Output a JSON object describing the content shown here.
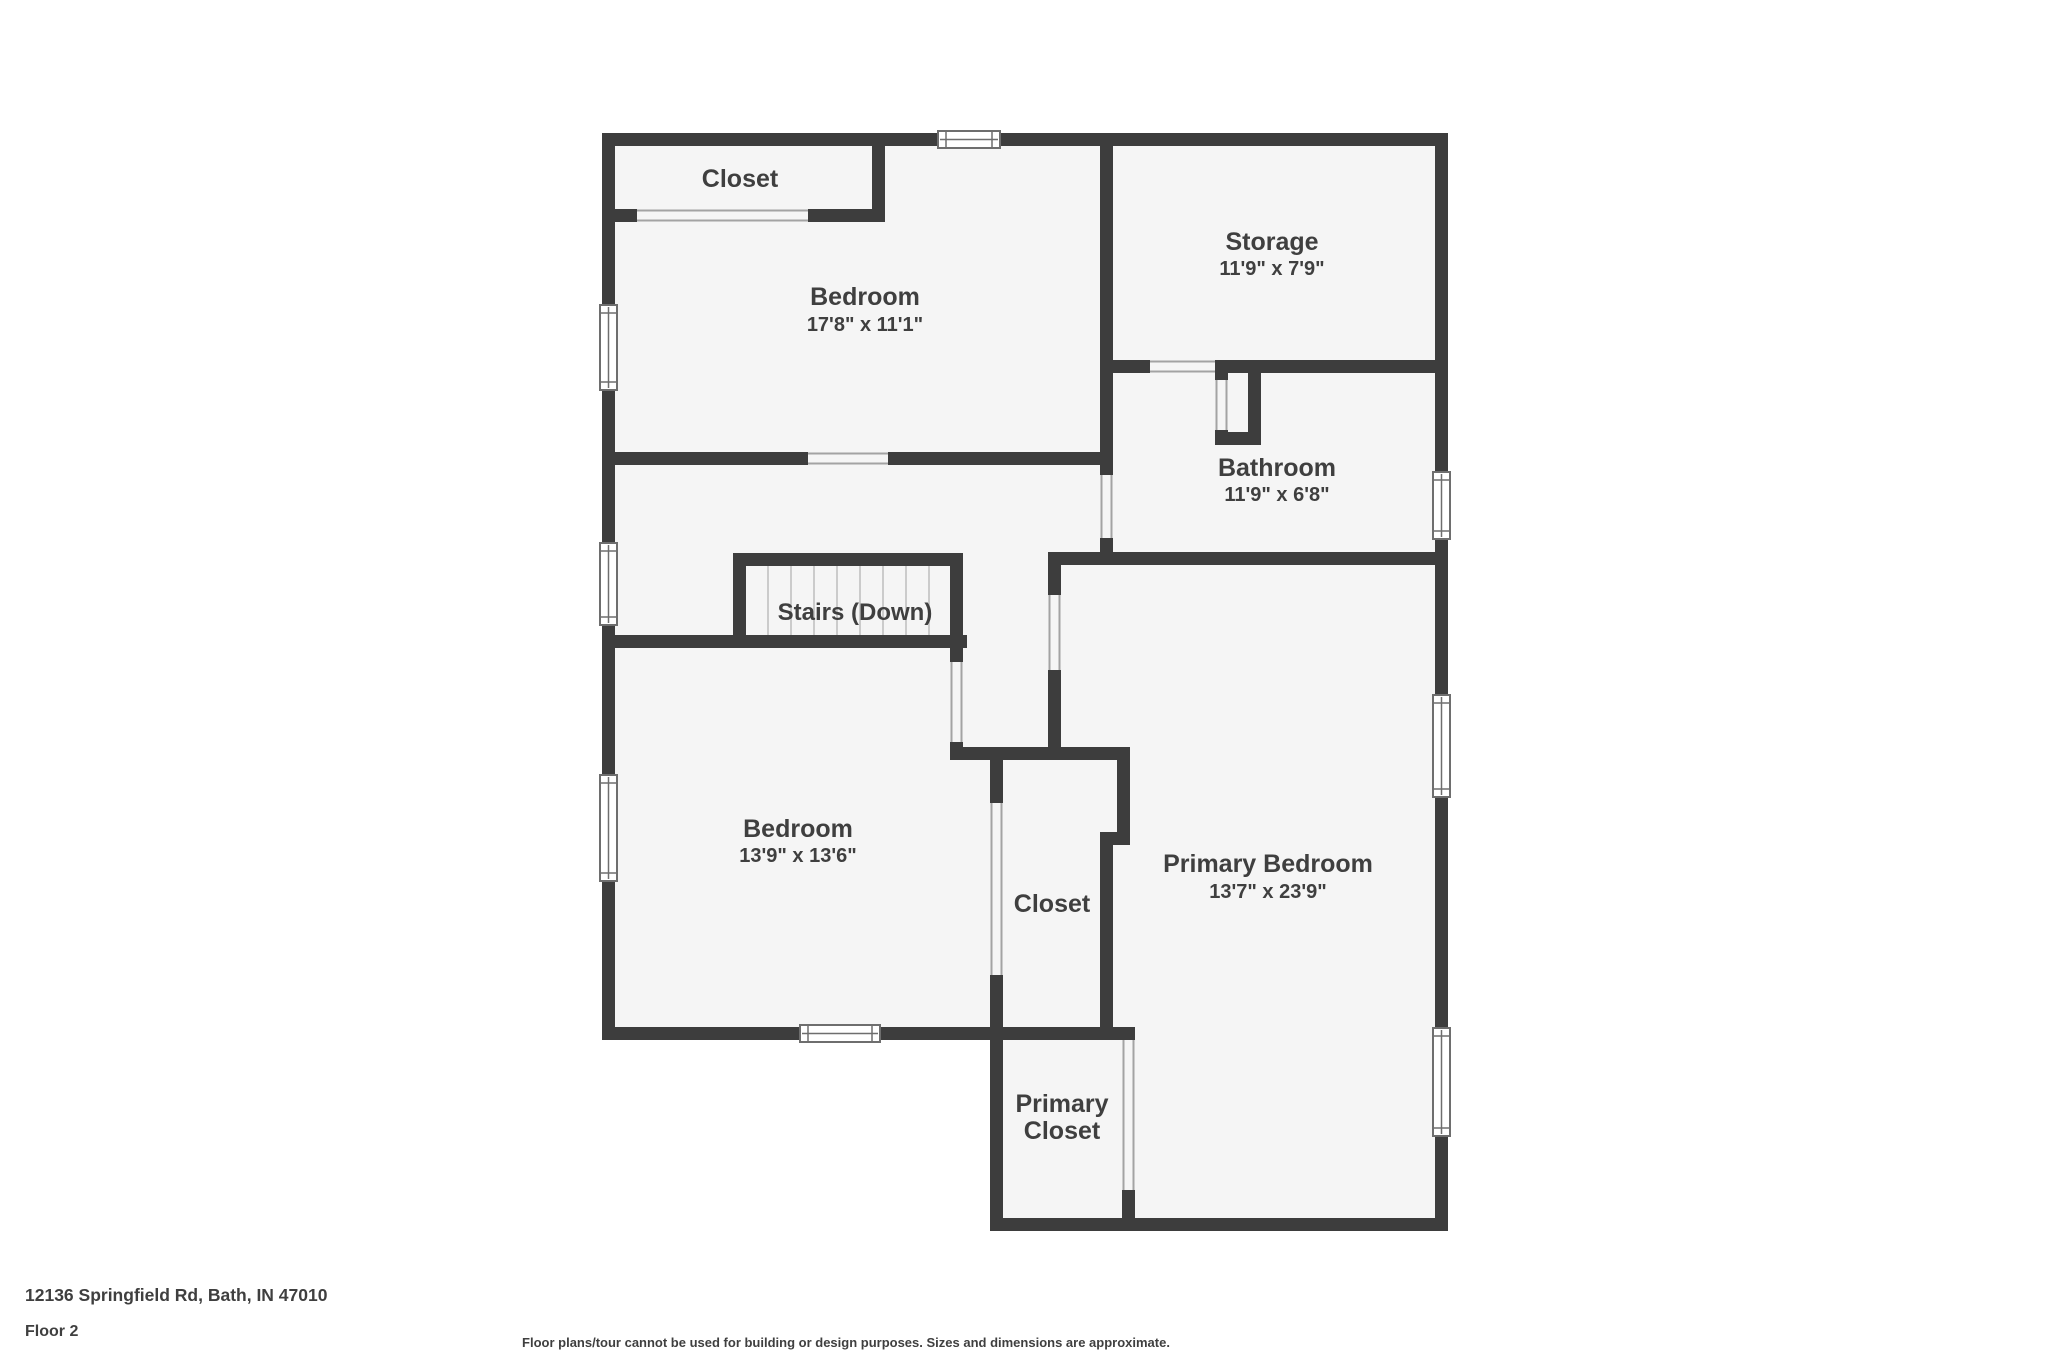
{
  "rooms": {
    "closet_top": {
      "label": "Closet"
    },
    "bedroom_top": {
      "label": "Bedroom",
      "dims": "17'8\" x 11'1\""
    },
    "storage": {
      "label": "Storage",
      "dims": "11'9\" x 7'9\""
    },
    "bathroom": {
      "label": "Bathroom",
      "dims": "11'9\" x 6'8\""
    },
    "stairs": {
      "label": "Stairs (Down)"
    },
    "bedroom_left": {
      "label": "Bedroom",
      "dims": "13'9\" x 13'6\""
    },
    "closet_middle": {
      "label": "Closet"
    },
    "primary_bedroom": {
      "label": "Primary Bedroom",
      "dims": "13'7\" x 23'9\""
    },
    "primary_closet": {
      "label": "Primary Closet",
      "line1": "Primary",
      "line2": "Closet"
    }
  },
  "footer": {
    "address": "12136 Springfield Rd, Bath, IN 47010",
    "floor": "Floor 2",
    "disclaimer": "Floor plans/tour cannot be used for building or design purposes. Sizes and dimensions are approximate."
  },
  "colors": {
    "wall": "#3d3d3d",
    "floor": "#f5f5f5",
    "text": "#3f3f3f",
    "page_bg": "#ffffff",
    "opening_line": "#a3a3a3",
    "window_border": "#6e6e6e",
    "tread_line": "#bdbdbd"
  }
}
